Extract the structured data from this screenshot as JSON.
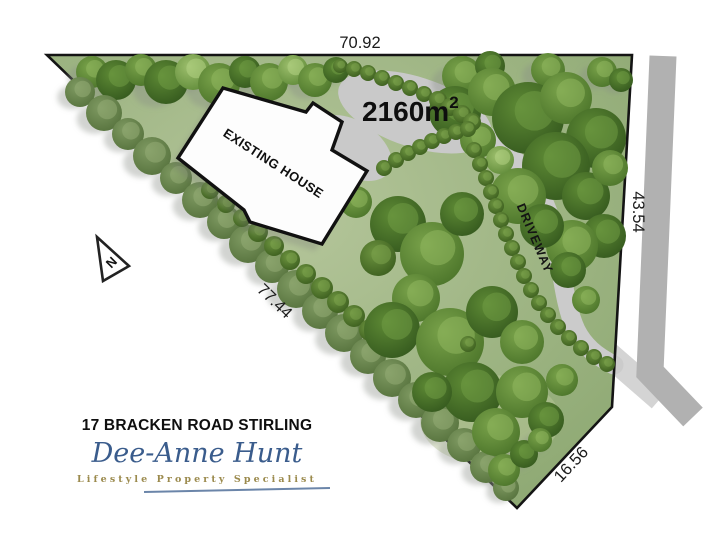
{
  "plan": {
    "area_value": "2160m",
    "area_sup": "2",
    "dim_top": "70.92",
    "dim_right": "43.54",
    "dim_hyp": "77.44",
    "dim_bottom": "16.56",
    "house_label": "EXISTING HOUSE",
    "driveway_label": "DRIVEWAY",
    "north_label": "N"
  },
  "footer": {
    "address": "17 BRACKEN ROAD STIRLING",
    "agent_name": "Dee-Anne Hunt",
    "agent_tagline": "Lifestyle Property Specialist"
  },
  "colors": {
    "grass_light": "#b5c69b",
    "grass_dark": "#8da872",
    "road_gray": "#b1b1b1",
    "driveway_gray": "#c9c9c9",
    "signature_blue": "#3a5c8c",
    "tagline_gold": "#9b8a4d",
    "boundary_black": "#141414"
  }
}
